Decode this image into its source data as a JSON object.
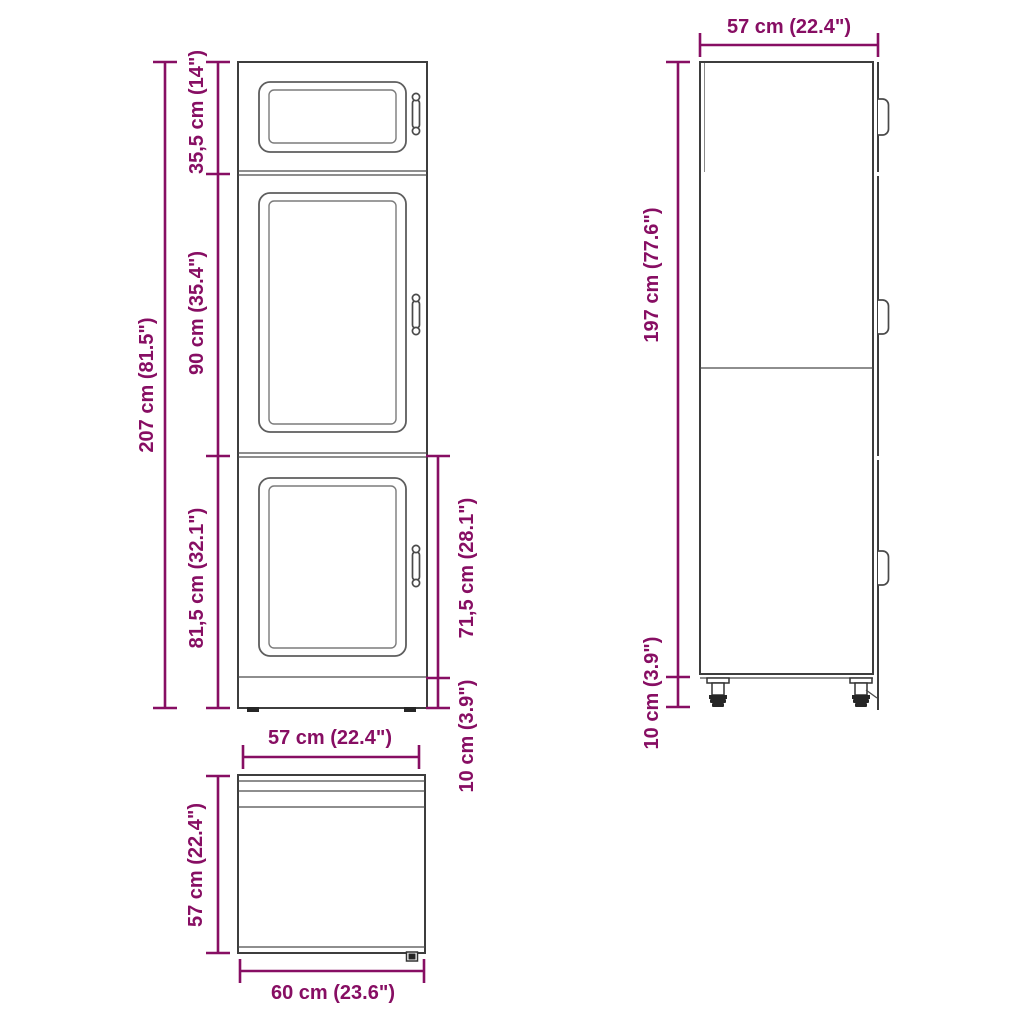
{
  "colors": {
    "dimension": "#870e63",
    "outline": "#3d3d3d",
    "panel_line": "#5d5d5d",
    "background": "#ffffff"
  },
  "front_view": {
    "total_height": "207 cm (81.5\")",
    "top_door_height": "35,5 cm (14\")",
    "middle_door_height": "90 cm (35.4\")",
    "lower_section_height": "81,5 cm (32.1\")",
    "lower_door_height": "71,5 cm (28.1\")",
    "plinth_height": "10 cm (3.9\")"
  },
  "side_view": {
    "depth": "57 cm (22.4\")",
    "carcass_height": "197 cm (77.6\")",
    "leg_height": "10 cm (3.9\")"
  },
  "top_view": {
    "width": "57 cm (22.4\")",
    "depth": "57 cm (22.4\")",
    "total_width": "60 cm (23.6\")"
  }
}
